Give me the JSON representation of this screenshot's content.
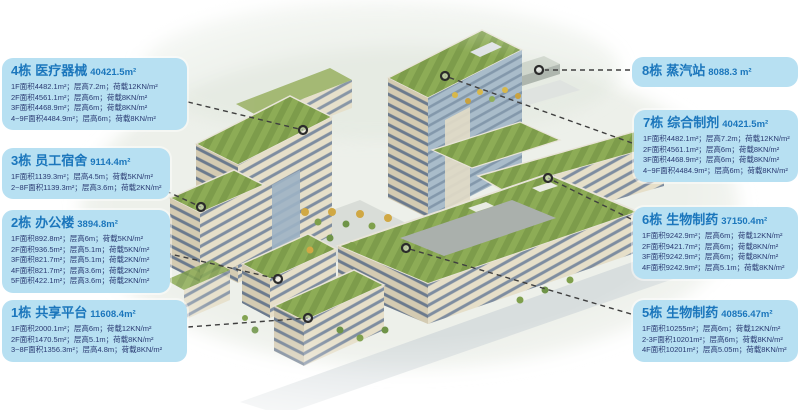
{
  "colors": {
    "callout_bg": "#b7e0f2",
    "title_blue": "#1b76bc",
    "detail_navy": "#2a3a72",
    "connector_gray": "#3f3f3f",
    "roof_green": "#8dac56",
    "facade_tan": "#e6dfc9",
    "glass_blue": "#9fb3c2"
  },
  "callouts": [
    {
      "building": "4栋",
      "name": "医疗器械",
      "area": "40421.5m²",
      "lines": [
        "1F面积4482.1m²；层高7.2m；荷载12KN/m²",
        "2F面积4561.1m²；层高6m；荷载8KN/m²",
        "3F面积4468.9m²；层高6m；荷载8KN/m²",
        "4~9F面积4484.9m²；层高6m；荷载8KN/m²"
      ]
    },
    {
      "building": "3栋",
      "name": "员工宿舍",
      "area": "9114.4m²",
      "lines": [
        "1F面积1139.3m²；层高4.5m；荷载5KN/m²",
        "2~8F面积1139.3m²；层高3.6m；荷载2KN/m²"
      ]
    },
    {
      "building": "2栋",
      "name": "办公楼",
      "area": "3894.8m²",
      "lines": [
        "1F面积892.8m²；层高6m；荷载5KN/m²",
        "2F面积936.5m²；层高5.1m；荷载5KN/m²",
        "3F面积821.7m²；层高5.1m；荷载2KN/m²",
        "4F面积821.7m²；层高3.6m；荷载2KN/m²",
        "5F面积422.1m²；层高3.6m；荷载2KN/m²"
      ]
    },
    {
      "building": "1栋",
      "name": "共享平台",
      "area": "11608.4m²",
      "lines": [
        "1F面积2000.1m²；层高6m；荷载12KN/m²",
        "2F面积1470.5m²；层高5.1m；荷载8KN/m²",
        "3~8F面积1356.3m²；层高4.8m；荷载8KN/m²"
      ]
    },
    {
      "building": "8栋",
      "name": "蒸汽站",
      "area": "8088.3 m²",
      "lines": []
    },
    {
      "building": "7栋",
      "name": "综合制剂",
      "area": "40421.5m²",
      "lines": [
        "1F面积4482.1m²；层高7.2m；荷载12KN/m²",
        "2F面积4561.1m²；层高6m；荷载8KN/m²",
        "3F面积4468.9m²；层高6m；荷载8KN/m²",
        "4~9F面积4484.9m²；层高6m；荷载8KN/m²"
      ]
    },
    {
      "building": "6栋",
      "name": "生物制药",
      "area": "37150.4m²",
      "lines": [
        "1F面积9242.9m²；层高6m；荷载12KN/m²",
        "2F面积9421.7m²；层高6m；荷载8KN/m²",
        "3F面积9242.9m²；层高6m；荷载8KN/m²",
        "4F面积9242.9m²；层高5.1m；荷载8KN/m²"
      ]
    },
    {
      "building": "5栋",
      "name": "生物制药",
      "area": "40856.47m²",
      "lines": [
        "1F面积10255m²；层高6m；荷载12KN/m²",
        "2-3F面积10201m²；层高6m；荷载8KN/m²",
        "4F面积10201m²；层高5.05m；荷载8KN/m²"
      ]
    }
  ]
}
